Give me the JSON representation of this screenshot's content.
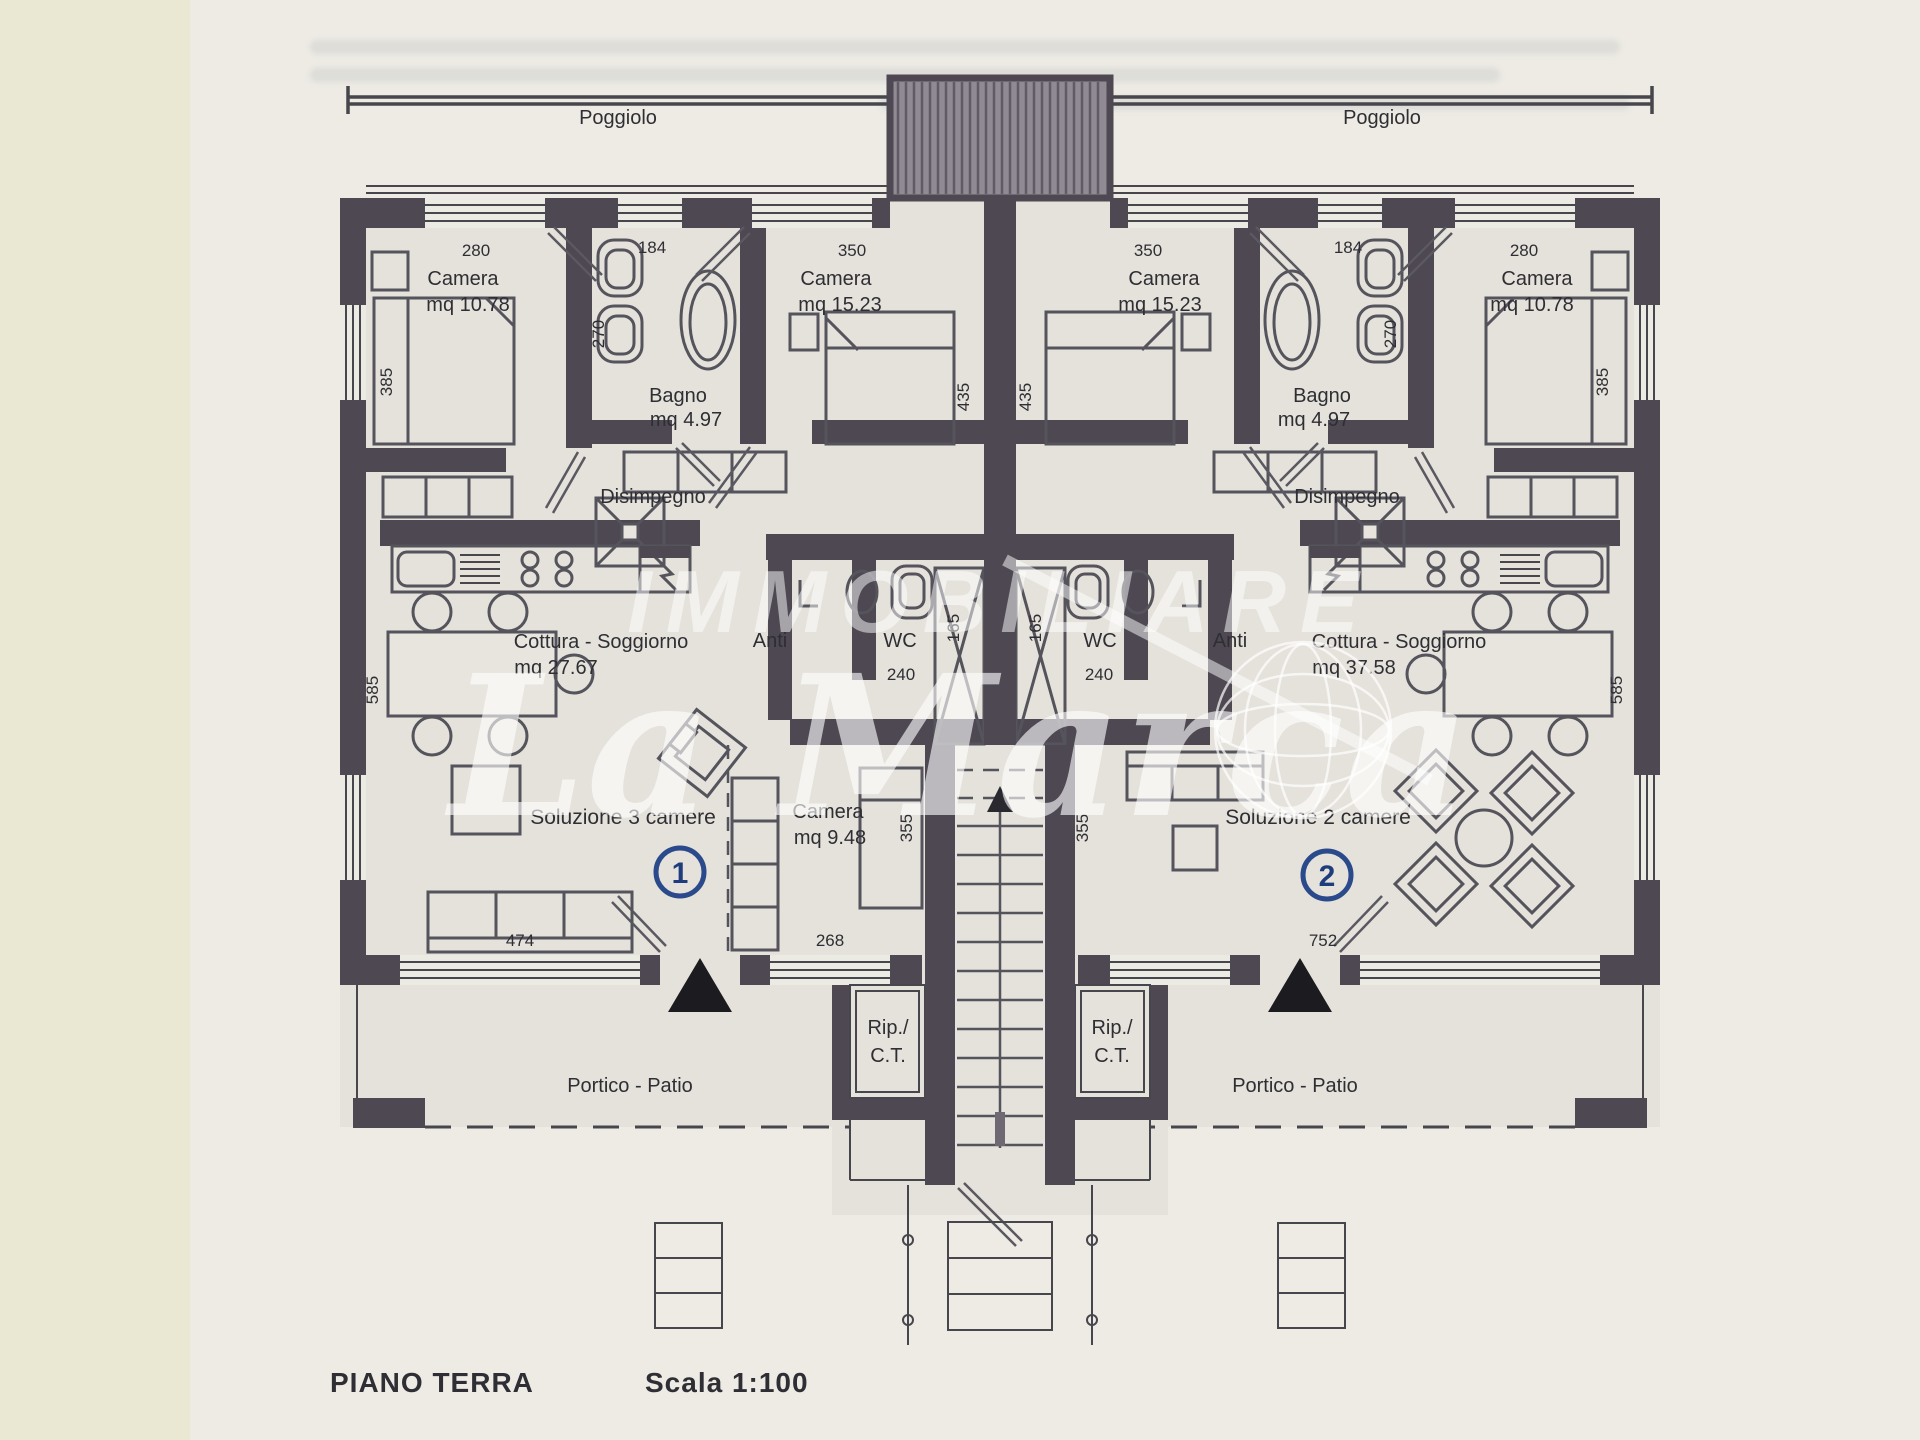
{
  "page": {
    "floor_label": "PIANO TERRA",
    "scale_label": "Scala 1:100"
  },
  "watermark": {
    "brand_top": "IMMOBILIARE",
    "brand_main": "La Marca"
  },
  "plan": {
    "balcony_left": "Poggiolo",
    "balcony_right": "Poggiolo",
    "left": {
      "camera1_name": "Camera",
      "camera1_area": "mq 10.78",
      "camera1_w": "280",
      "camera1_d": "385",
      "bagno_name": "Bagno",
      "bagno_area": "mq 4.97",
      "bagno_w": "184",
      "bagno_d": "270",
      "camera2_name": "Camera",
      "camera2_area": "mq 15.23",
      "camera2_w": "350",
      "camera2_d": "435",
      "disimpegno": "Disimpegno",
      "soggiorno_name": "Cottura - Soggiorno",
      "soggiorno_area": "mq 27.67",
      "soggiorno_d": "585",
      "anti": "Anti",
      "wc": "WC",
      "wc_w": "240",
      "shower_d": "165",
      "camera3_name": "Camera",
      "camera3_area": "mq 9.48",
      "camera3_d": "355",
      "win1": "474",
      "win2": "268",
      "solution": "Soluzione 3 camere",
      "unit_no": "1",
      "rip1": "Rip./",
      "rip2": "C.T.",
      "portico": "Portico - Patio"
    },
    "right": {
      "camera1_name": "Camera",
      "camera1_area": "mq 15.23",
      "camera1_w": "350",
      "camera1_d": "435",
      "bagno_name": "Bagno",
      "bagno_area": "mq 4.97",
      "bagno_w": "184",
      "bagno_d": "270",
      "camera2_name": "Camera",
      "camera2_area": "mq 10.78",
      "camera2_w": "280",
      "camera2_d": "385",
      "disimpegno": "Disimpegno",
      "soggiorno_name": "Cottura - Soggiorno",
      "soggiorno_area": "mq 37.58",
      "soggiorno_d": "585",
      "anti": "Anti",
      "wc": "WC",
      "wc_w": "240",
      "shower_d": "165",
      "sofa_d": "355",
      "win1": "752",
      "solution": "Soluzione 2 camere",
      "unit_no": "2",
      "rip1": "Rip./",
      "rip2": "C.T.",
      "portico": "Portico - Patio"
    }
  },
  "colors": {
    "wall": "#4d4852",
    "paper": "#edebe4",
    "margin_strip": "#eae7d2",
    "accent_blue": "#2a4a8c",
    "watermark": "#ffffff"
  }
}
